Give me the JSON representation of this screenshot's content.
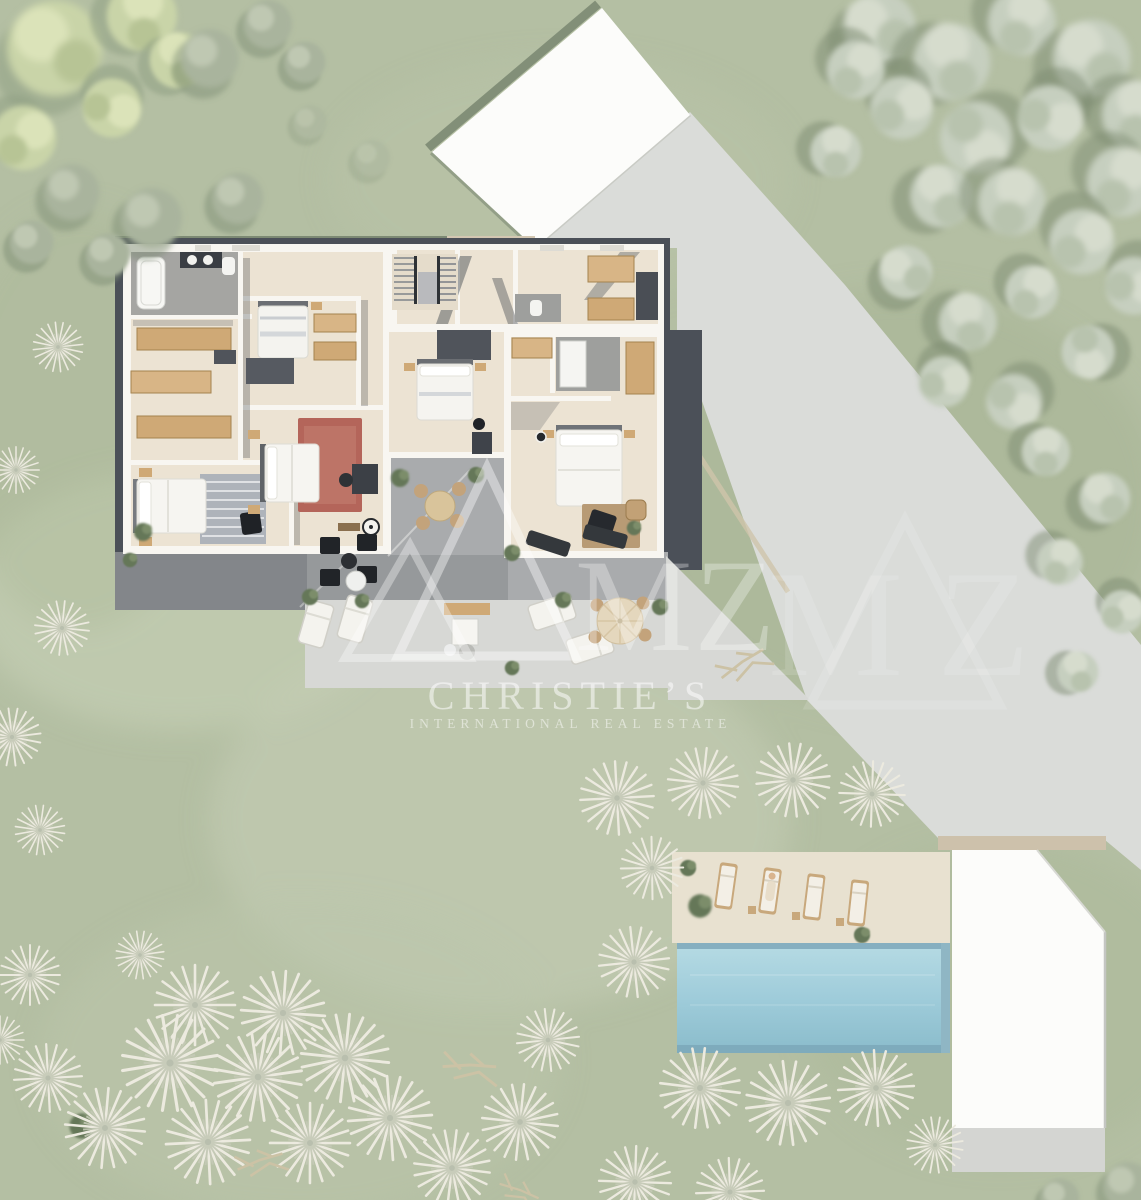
{
  "watermark": {
    "logo_text": "MZ",
    "logo_text_repeat": "MZ",
    "brand_line1": "CHRISTIE’S",
    "brand_line2": "INTERNATIONAL REAL ESTATE"
  },
  "scene": {
    "type": "aerial-3d-floor-plan-render",
    "bedrooms_visible": 5,
    "features": [
      "lawn",
      "driveway",
      "garage-roof",
      "villa-floor-plan",
      "bathroom",
      "dressing-room",
      "master-bedroom",
      "guest-suite",
      "staircase",
      "laundry",
      "courtyard-dining",
      "lounge-terrace",
      "sun-loungers",
      "parasol-dining-set",
      "swimming-pool",
      "pool-deck",
      "pool-house-roof",
      "palm-trees",
      "olive-trees",
      "hedges"
    ]
  },
  "palette": {
    "grass": "#b4bfa3",
    "grass_light": "#c9d2b6",
    "grass_dark": "#9fae90",
    "driveway": "#dadcd9",
    "terrace_light": "#d7d8d5",
    "terrace_mid": "#a8abac",
    "terrace_dark": "#84878a",
    "gravel": "#4b5058",
    "wall": "#f8f6f1",
    "floor": "#ece3d3",
    "floor_gray": "#a5a5a2",
    "wood": "#cfa976",
    "rug_red": "#b4655a",
    "rug_gray": "#aeb3ba",
    "rug_brown": "#b3926a",
    "furniture_black": "#23262a",
    "pool": "#9fccda",
    "pool_deck": "#e8e1d0",
    "roof": "#fcfcfa",
    "hedge": "#7d8a74",
    "olive_tree": "#c6cfbf",
    "leaf_tree": "#c9d4a8",
    "palm": "#eceadf"
  }
}
